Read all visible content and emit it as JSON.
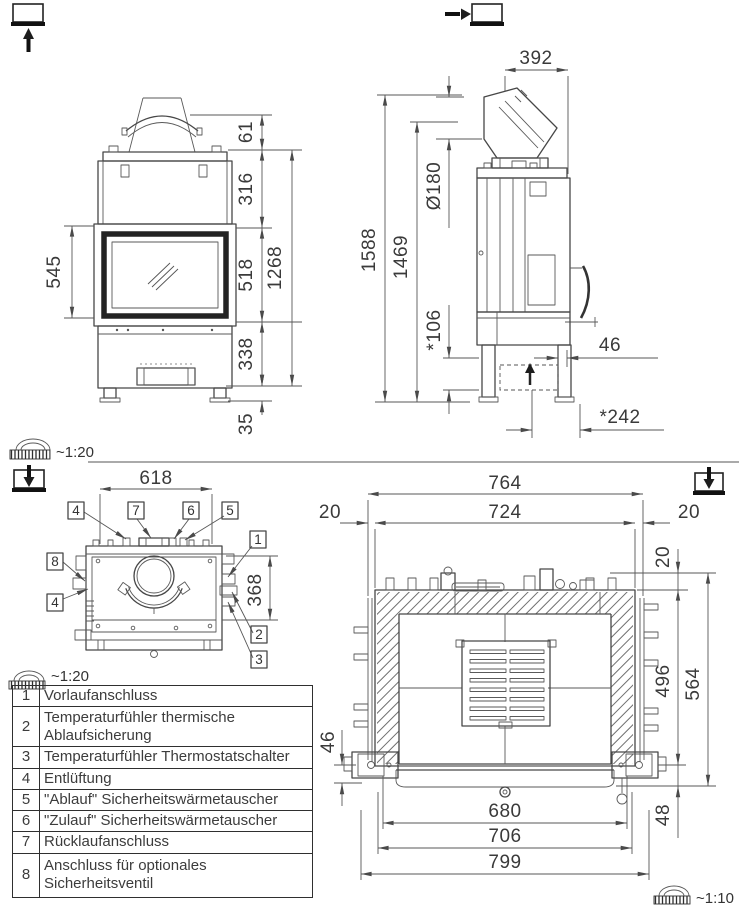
{
  "scales": {
    "upper": "~1:20",
    "plan": "~1:20",
    "section": "~1:10"
  },
  "front_view": {
    "dims": {
      "glass_height": "545",
      "flue_height": "61",
      "upper_height": "316",
      "door_height": "518",
      "lower_height": "338",
      "foot_height": "35",
      "total_height": "1268"
    }
  },
  "side_view": {
    "dims": {
      "flue_depth": "392",
      "flue_diameter": "Ø180",
      "total_height": "1588",
      "outlet_height": "1469",
      "base_height": "*106",
      "rear_gap": "46",
      "rear_depth": "*242"
    }
  },
  "plan_view": {
    "dims": {
      "width": "618",
      "depth": "368"
    },
    "callouts": {
      "c4a": "4",
      "c7": "7",
      "c6": "6",
      "c5": "5",
      "c1": "1",
      "c8": "8",
      "c4b": "4",
      "c2": "2",
      "c3": "3"
    }
  },
  "section_view": {
    "dims": {
      "overall_width": "764",
      "inner_width": "724",
      "gap_left": "20",
      "gap_right": "20",
      "gap_top": "20",
      "inner_depth": "496",
      "outer_depth": "564",
      "hinge_height": "46",
      "door_width": "680",
      "frame_width": "706",
      "base_width": "799",
      "front_height": "48"
    }
  },
  "legend": {
    "rows": [
      {
        "num": "1",
        "label": "Vorlaufanschluss"
      },
      {
        "num": "2",
        "label": "Temperaturfühler thermische Ablaufsicherung"
      },
      {
        "num": "3",
        "label": "Temperaturfühler Thermostatschalter"
      },
      {
        "num": "4",
        "label": "Entlüftung"
      },
      {
        "num": "5",
        "label": "\"Ablauf\" Sicherheitswärmetauscher"
      },
      {
        "num": "6",
        "label": "\"Zulauf\" Sicherheitswärmetauscher"
      },
      {
        "num": "7",
        "label": "Rücklaufanschluss"
      },
      {
        "num": "8",
        "label": "Anschluss für optionales Sicherheitsventil"
      }
    ]
  }
}
